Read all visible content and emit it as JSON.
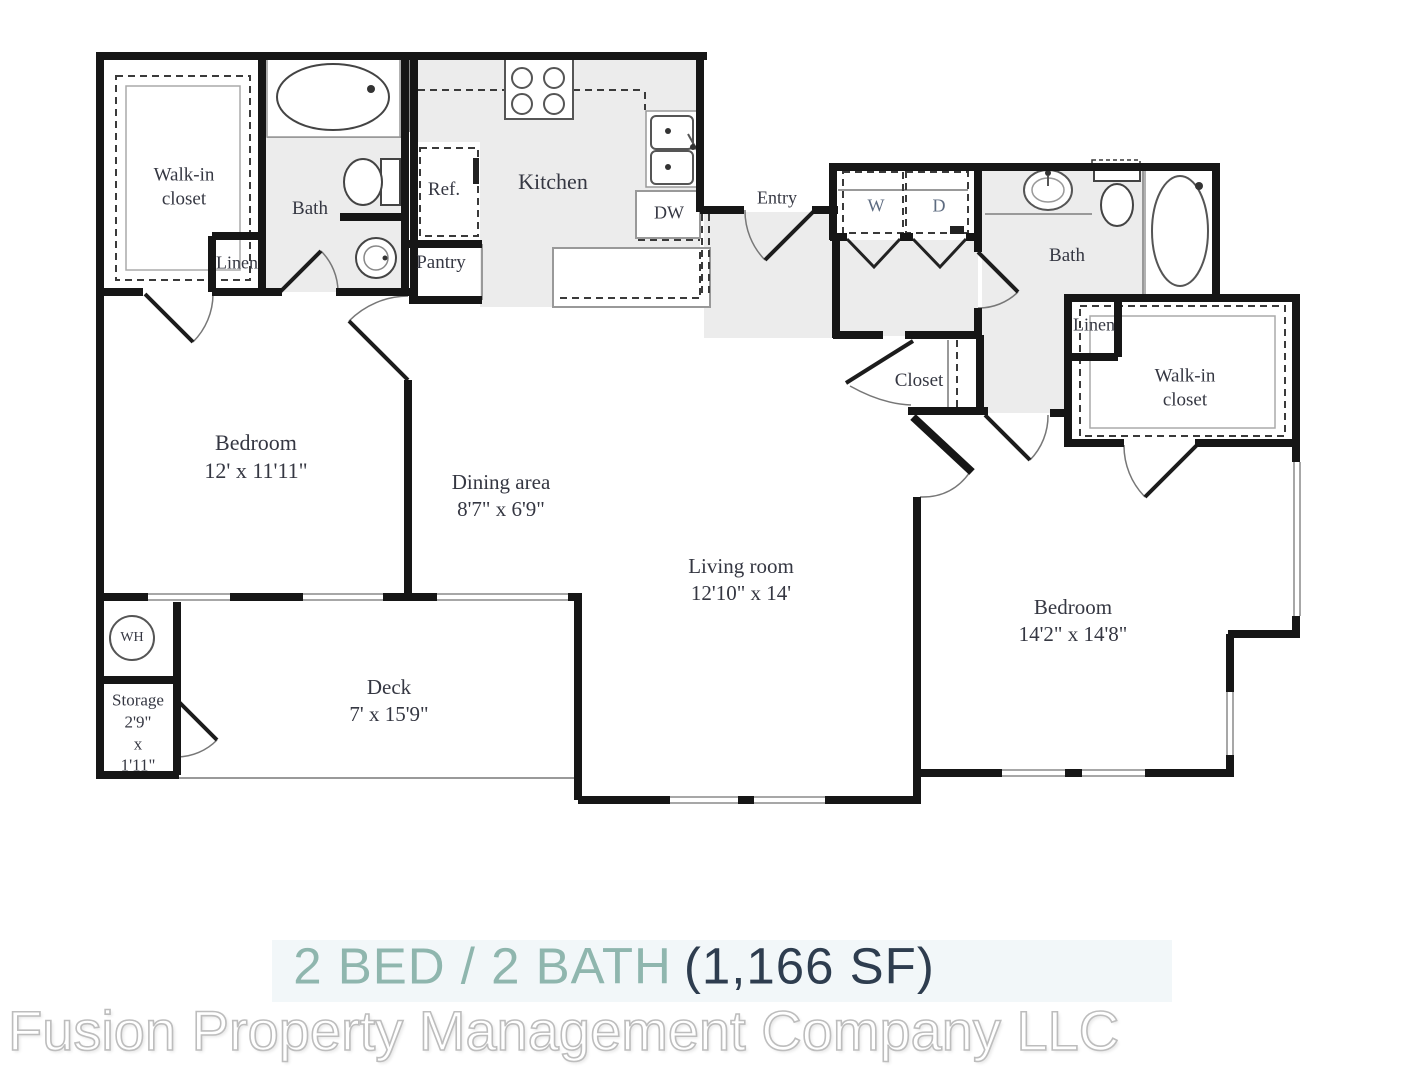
{
  "footer": {
    "beds_baths": "2 BED / 2 BATH",
    "sqft": "(1,166 SF)"
  },
  "watermark": "Fusion Property Management Company LLC",
  "colors": {
    "accent_teal": "#8fb6ae",
    "dark_navy": "#2e3d4f",
    "wall_black": "#161616",
    "floor_gray": "#ececec",
    "label_ink": "#353742",
    "watermark_gray": "#bdbdbd"
  },
  "rooms": {
    "walk_in_closet_1": {
      "name": "Walk-in closet"
    },
    "linen_1": {
      "name": "Linen"
    },
    "bath_1": {
      "name": "Bath"
    },
    "fridge": {
      "name": "Ref."
    },
    "pantry": {
      "name": "Pantry"
    },
    "kitchen": {
      "name": "Kitchen"
    },
    "dishwasher": {
      "name": "DW"
    },
    "entry": {
      "name": "Entry"
    },
    "washer": {
      "name": "W"
    },
    "dryer": {
      "name": "D"
    },
    "bath_2": {
      "name": "Bath"
    },
    "linen_2": {
      "name": "Linen"
    },
    "walk_in_closet_2": {
      "name": "Walk-in closet"
    },
    "closet": {
      "name": "Closet"
    },
    "bedroom_1": {
      "name": "Bedroom",
      "dims": "12' x 11'11\""
    },
    "dining_area": {
      "name": "Dining area",
      "dims": "8'7\" x 6'9\""
    },
    "living_room": {
      "name": "Living room",
      "dims": "12'10\" x 14'"
    },
    "bedroom_2": {
      "name": "Bedroom",
      "dims": "14'2\" x 14'8\""
    },
    "water_heater": {
      "name": "WH"
    },
    "storage": {
      "name": "Storage",
      "dims": "2'9\"\nx\n1'11\""
    },
    "deck": {
      "name": "Deck",
      "dims": "7' x 15'9\""
    }
  }
}
